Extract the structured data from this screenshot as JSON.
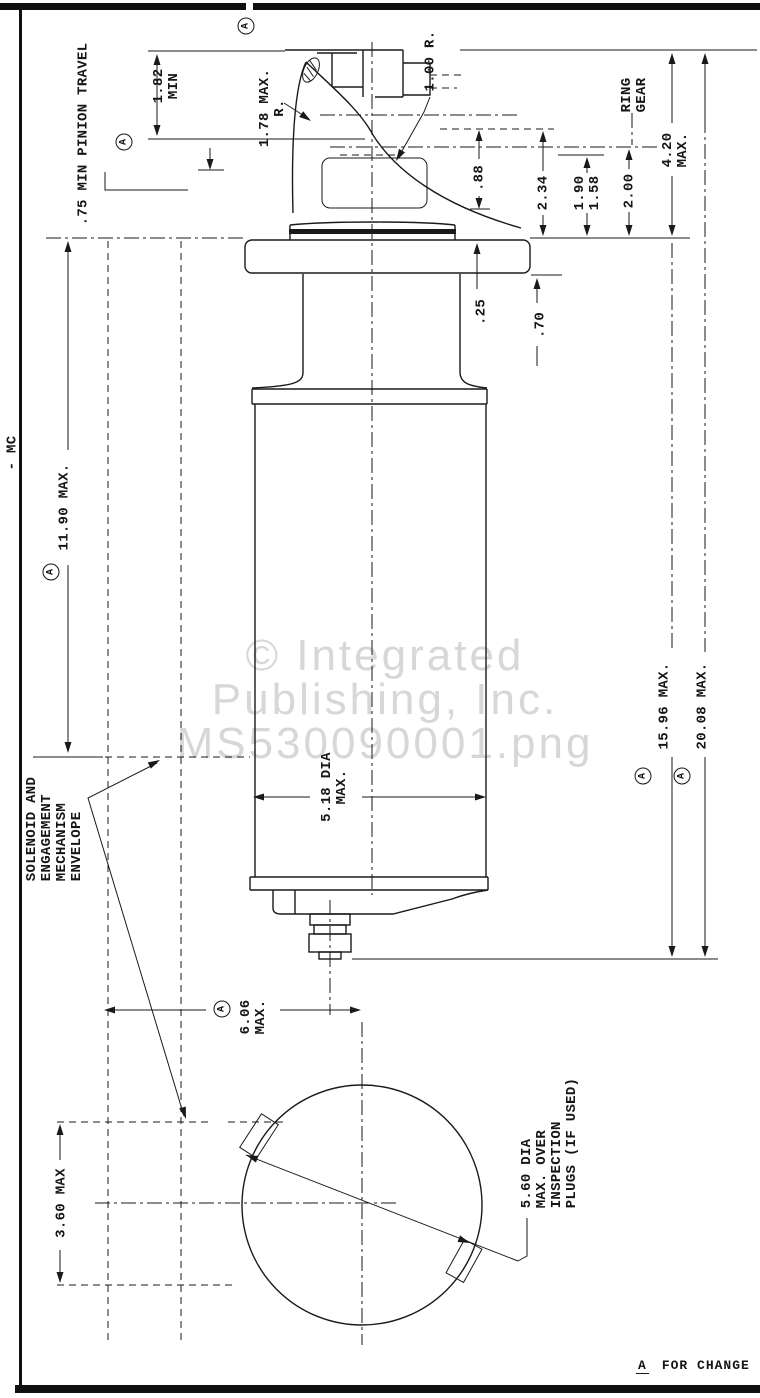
{
  "document": {
    "watermark": {
      "line1": "© Integrated",
      "line2": "Publishing, Inc.",
      "line3": "MS530090001.png"
    },
    "side_label": "- MC",
    "revision_note": {
      "marker": "A",
      "text": "FOR CHANGE"
    }
  },
  "drawing": {
    "labels": {
      "pinion_travel": ".75 MIN PINION TRAVEL",
      "dim_1_82": "1.82\nMIN",
      "dim_1_78": "1.78 MAX.\nR.",
      "dim_1_00": "1.00 R.",
      "ring_gear": "RING\nGEAR",
      "dim_0_88": ".88",
      "dim_2_34": "2.34",
      "dim_1_90_1_58": "1.90\n1.58",
      "dim_2_00": "2.00",
      "dim_4_20": "4.20\nMAX.",
      "dim_0_25": ".25",
      "dim_0_70": ".70",
      "dim_11_90": "11.90 MAX.",
      "dim_5_18": "5.18 DIA\nMAX.",
      "solenoid_note": "SOLENOID AND\nENGAGEMENT\nMECHANISM\nENVELOPE",
      "dim_15_96": "15.96 MAX.",
      "dim_20_08": "20.08 MAX.",
      "dim_6_06": "6.06\nMAX.",
      "dim_3_60": "3.60 MAX",
      "dim_5_60": "5.60 DIA\nMAX. OVER\nINSPECTION\nPLUGS (IF USED)",
      "datum_marker": "A"
    }
  }
}
